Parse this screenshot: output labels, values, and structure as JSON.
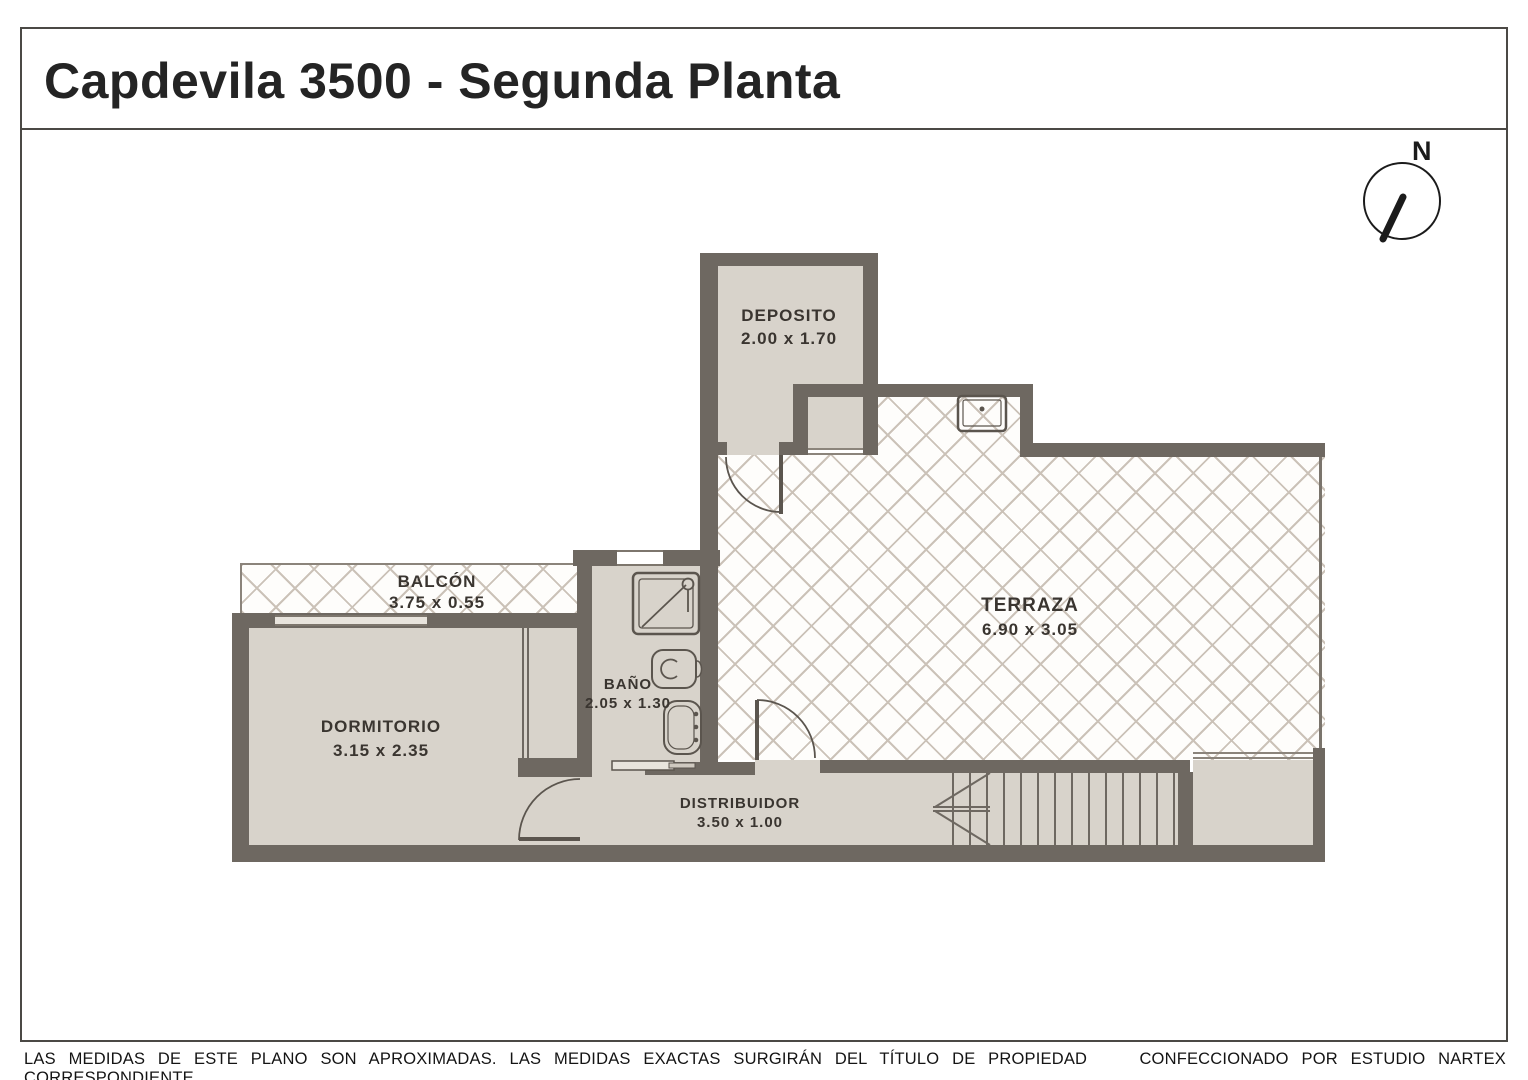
{
  "title": "Capdevila 3500 - Segunda Planta",
  "compass": {
    "label": "N"
  },
  "rooms": {
    "deposito": {
      "name": "DEPOSITO",
      "dims": "2.00 x 1.70"
    },
    "terraza": {
      "name": "TERRAZA",
      "dims": "6.90 x 3.05"
    },
    "balcon": {
      "name": "BALCÓN",
      "dims": "3.75 x 0.55"
    },
    "dormitorio": {
      "name": "DORMITORIO",
      "dims": "3.15 x 2.35"
    },
    "bano": {
      "name": "BAÑO",
      "dims": "2.05 x 1.30"
    },
    "distribuidor": {
      "name": "DISTRIBUIDOR",
      "dims": "3.50 x 1.00"
    }
  },
  "footer": {
    "disclaimer": "LAS MEDIDAS DE ESTE PLANO SON APROXIMADAS. LAS MEDIDAS EXACTAS SURGIRÁN DEL TÍTULO DE PROPIEDAD CORRESPONDIENTE.",
    "credit": "CONFECCIONADO POR ESTUDIO NARTEX"
  },
  "colors": {
    "wall": "#6e6861",
    "floor": "#d8d3cb",
    "hatch_line": "#cbc2b8",
    "frame": "#4b4945",
    "text": "#3a3530"
  }
}
